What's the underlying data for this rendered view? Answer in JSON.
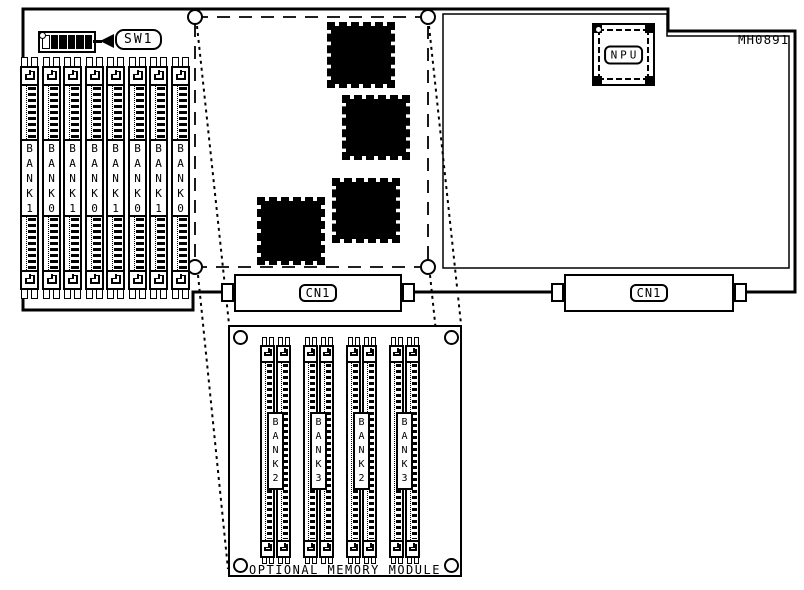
{
  "diagram": {
    "board_label": "MH0891",
    "dip_switch": {
      "label": "SW1",
      "positions": [
        "off",
        "on",
        "on",
        "on",
        "on",
        "on"
      ]
    },
    "npu_label": "NPU",
    "left_connector_label": "CN1",
    "right_connector_label": "CN1",
    "main_banks": [
      "BANK1",
      "BANK0",
      "BANK1",
      "BANK0",
      "BANK1",
      "BANK0",
      "BANK1",
      "BANK0"
    ],
    "module_banks": [
      "BANK2",
      "BANK3",
      "BANK2",
      "BANK3"
    ],
    "module_title": "OPTIONAL MEMORY MODULE"
  }
}
